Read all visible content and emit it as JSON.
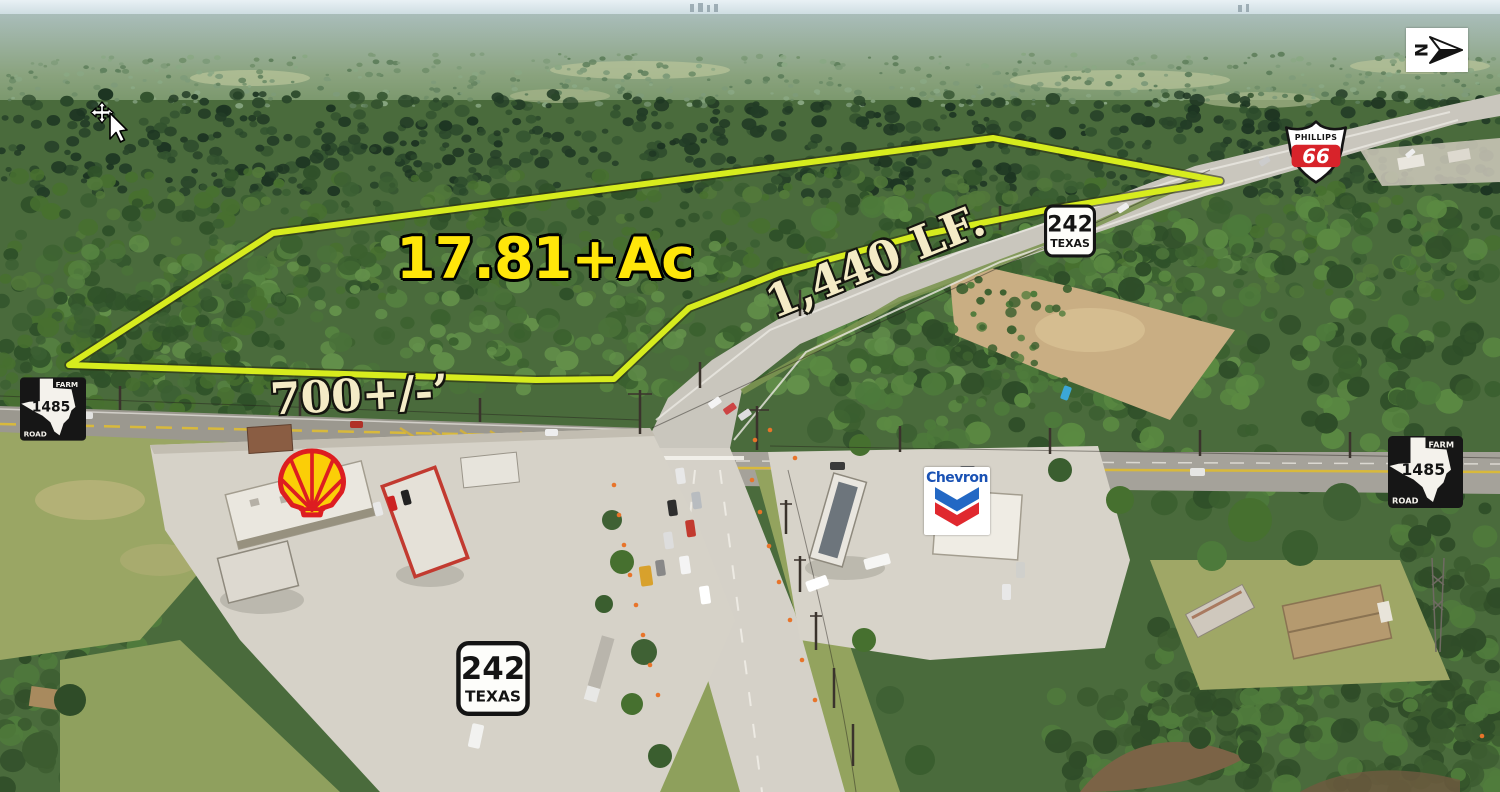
{
  "annotations": {
    "acreage": "17.81+Ac",
    "frontage": "1,440 LF.",
    "depth": "700+/-’"
  },
  "shields": {
    "tx242_top": {
      "route": "242",
      "state": "TEXAS"
    },
    "tx242_bottom": {
      "route": "242",
      "state": "TEXAS"
    },
    "fm1485_left": {
      "farm": "FARM",
      "route": "1485",
      "road": "ROAD"
    },
    "fm1485_right": {
      "farm": "FARM",
      "route": "1485",
      "road": "ROAD"
    }
  },
  "logos": {
    "phillips66": {
      "name": "PHILLIPS",
      "number": "66"
    },
    "chevron": {
      "name": "Chevron"
    },
    "shell": {
      "icon": "shell-pecten-icon"
    }
  },
  "compass": {
    "letter": "N",
    "icon": "north-arrow-icon"
  },
  "cursor": {
    "icon": "move-cursor-icon"
  },
  "colors": {
    "parcel_outline": "#d7ec1e",
    "acreage_text": "#ffe60a",
    "dimension_text": "#f4ebc6",
    "phillips_red": "#d8232a",
    "chevron_blue": "#2368c4",
    "chevron_red": "#e0282e",
    "shell_red": "#dd1d21",
    "shell_yellow": "#fbce07"
  }
}
